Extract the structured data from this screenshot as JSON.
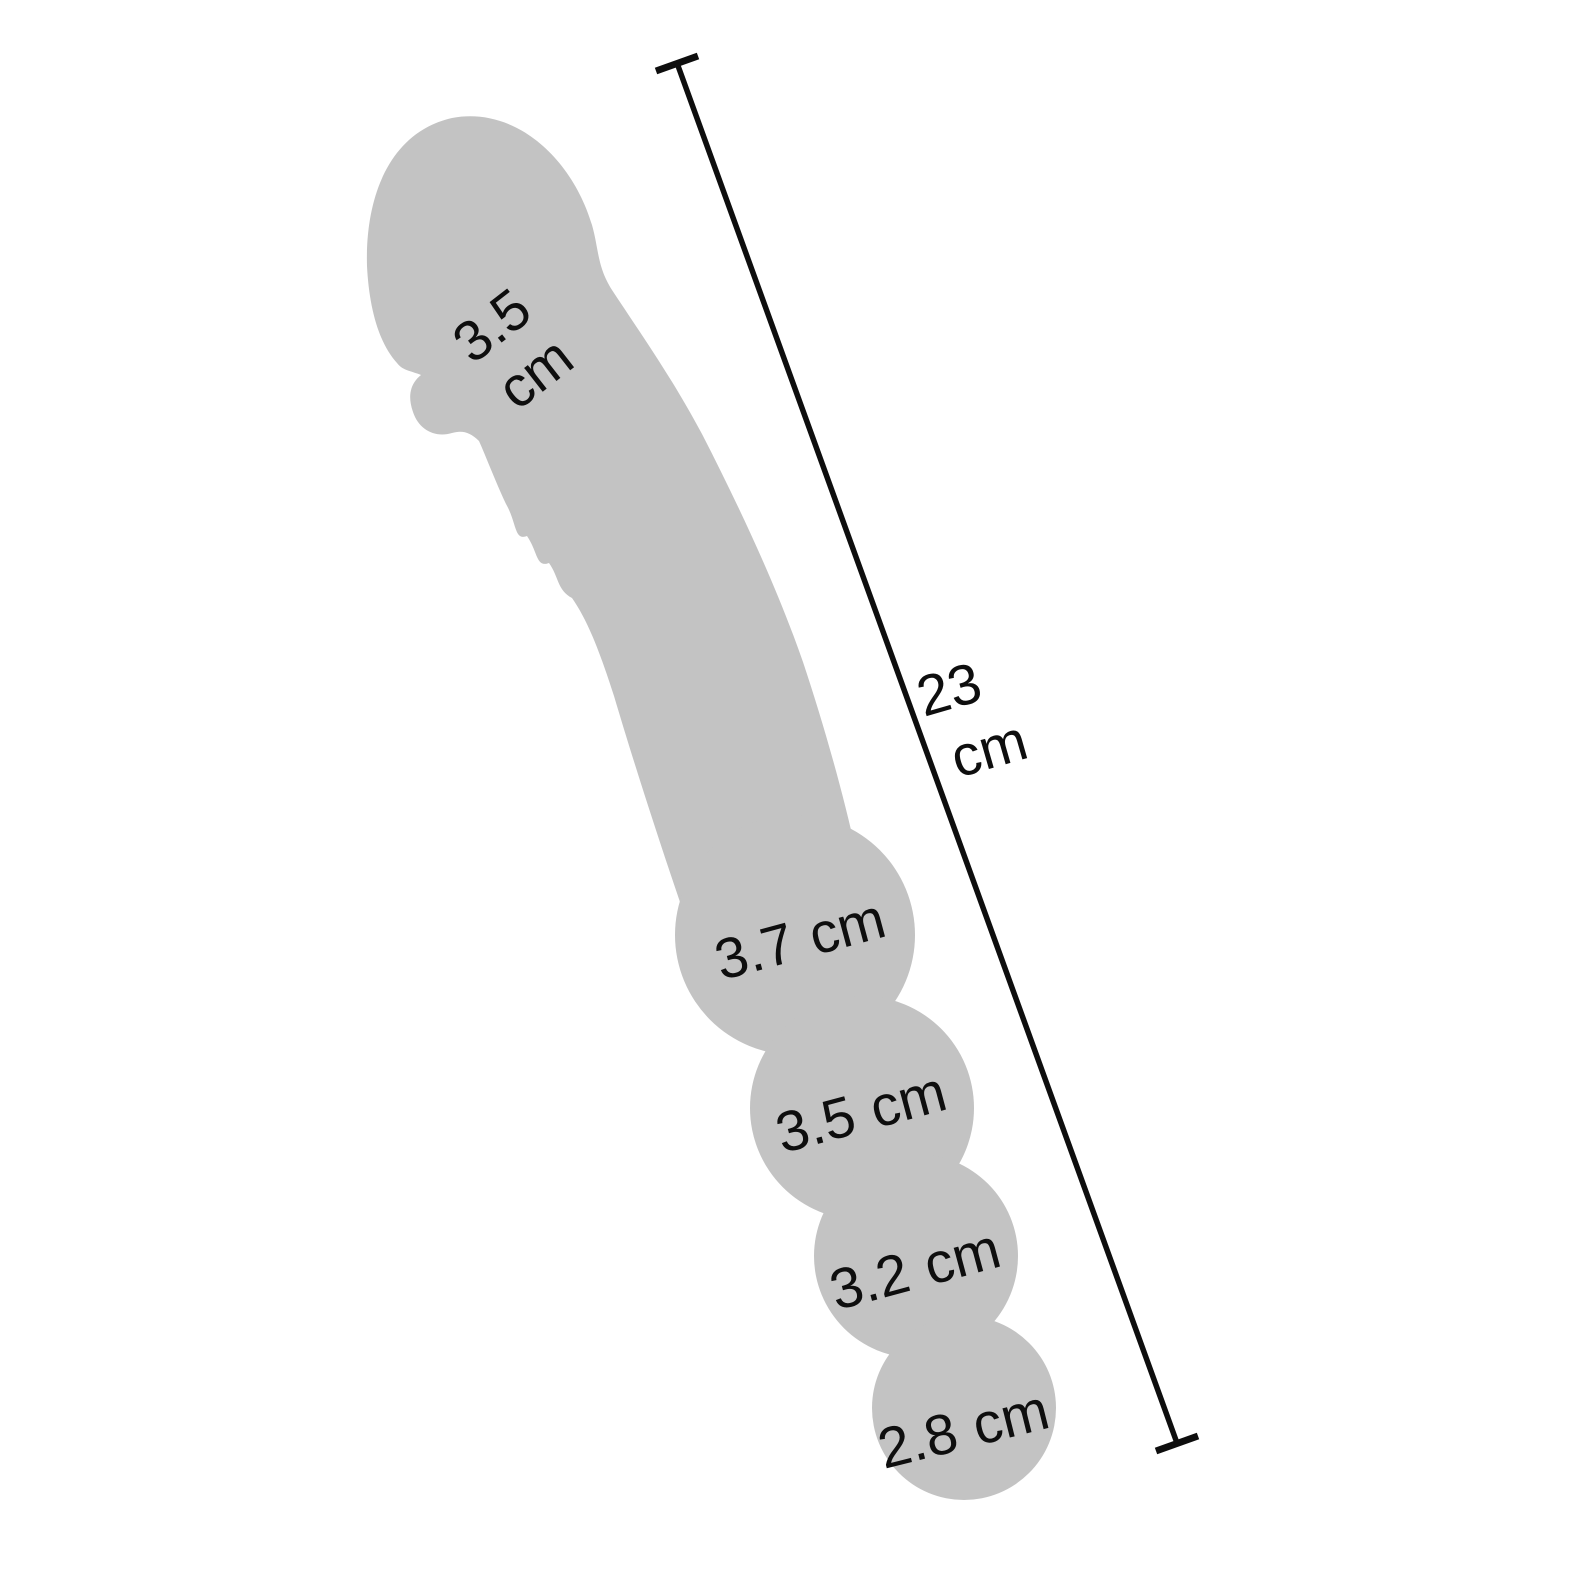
{
  "figure": {
    "background_color": "#ffffff",
    "silhouette_color": "#c3c3c3",
    "line_color": "#0e0e0e",
    "text_color": "#0e0e0e"
  },
  "measurements": {
    "head_width": {
      "value": "3.5",
      "unit": "cm"
    },
    "total_length": {
      "value": "23",
      "unit": "cm"
    },
    "bead_1_width": {
      "value": "3.7",
      "unit": "cm"
    },
    "bead_2_width": {
      "value": "3.5",
      "unit": "cm"
    },
    "bead_3_width": {
      "value": "3.2",
      "unit": "cm"
    },
    "bead_4_width": {
      "value": "2.8",
      "unit": "cm"
    }
  }
}
